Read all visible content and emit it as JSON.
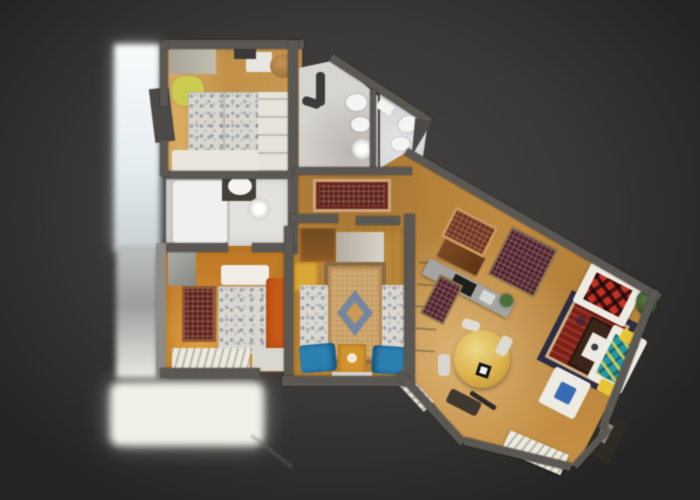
{
  "app": {
    "name": "apartment-3d-dollhouse-view",
    "description": "Top-down photogrammetry dollhouse scan of an apartment on a dark vignetted canvas; no visible text, chrome or controls"
  },
  "palette": {
    "bg_center": "#454443",
    "bg_edge": "#252525",
    "wall": "#5b5854",
    "wall_light": "#8e8c86",
    "wood_hall_living": "#c28e47",
    "wood_bedroom_twin": "#c99a55",
    "wood_bedroom_middle": "#b8873c",
    "wood_bedroom_double": "#bf7c2c",
    "bath_floor_small": "#e2e1dd",
    "bath_floor_main": "#d7d5d2",
    "bath_floor_ensuite": "#d3d6d8",
    "terrace_white": "#f1f1ea",
    "terrace_top": "#ecf2f5",
    "linen_white": "#d9d7cf",
    "rug_runner_red": "#5c2220",
    "rug_persian_red": "#7d2018",
    "rug_persian_border": "#2e2b44",
    "rug_maroon": "#4e2130",
    "rug_brown": "#6e3322",
    "rug_ornate_tan": "#c59d66",
    "rug_ornate_blue": "#76869e",
    "cushion_blue": "#2f7fae",
    "sofa_plaid_red": "#c03026",
    "sofa_plaid_teal": "#2a96a4",
    "sofa_base_white": "#eeebe3",
    "pillow_yellow": "#e5c33e",
    "dining_table_wood": "#d9b352",
    "kitchen_counter_gray": "#a4a4a0",
    "fixture_white": "#f4f4f2",
    "radiator_white": "#eceade",
    "plant_green": "#4c6e3c",
    "blanket_orange": "#c55c1d",
    "throw_yellow_green": "#c9cc55",
    "coffee_table_brown": "#3a241a"
  },
  "scene": {
    "view": "top-down dollhouse",
    "rooms": [
      {
        "name": "twin bedroom",
        "position": "top-left"
      },
      {
        "name": "small bathroom",
        "position": "left, below twin bedroom"
      },
      {
        "name": "main bathroom",
        "position": "top-center"
      },
      {
        "name": "ensuite shower room",
        "position": "top-center-right"
      },
      {
        "name": "hallway",
        "position": "center"
      },
      {
        "name": "middle bedroom",
        "position": "bottom-center"
      },
      {
        "name": "double bedroom",
        "position": "bottom-left"
      },
      {
        "name": "kitchen",
        "position": "center-right"
      },
      {
        "name": "living-dining room",
        "position": "right, rotated diagonally"
      },
      {
        "name": "balcony terrace (overexposed)",
        "position": "left edge"
      }
    ],
    "furniture": [
      "twin beds",
      "wardrobe",
      "round stool",
      "bathtub",
      "toilet",
      "washing machine",
      "shower",
      "sinks",
      "runner rug",
      "persian rugs",
      "ornate medallion rug",
      "double bed",
      "orange blanket",
      "blue cushions",
      "gold nightstand",
      "kitchen counter with cooktop",
      "fridge units",
      "wood sideboard",
      "red plaid sofa",
      "teal plaid sofa",
      "yellow pillows",
      "coffee table with white magazine",
      "round dining table with marker tag",
      "dining chairs",
      "white sofa with blue cushion",
      "radiators",
      "corner plant",
      "fireplace"
    ]
  }
}
